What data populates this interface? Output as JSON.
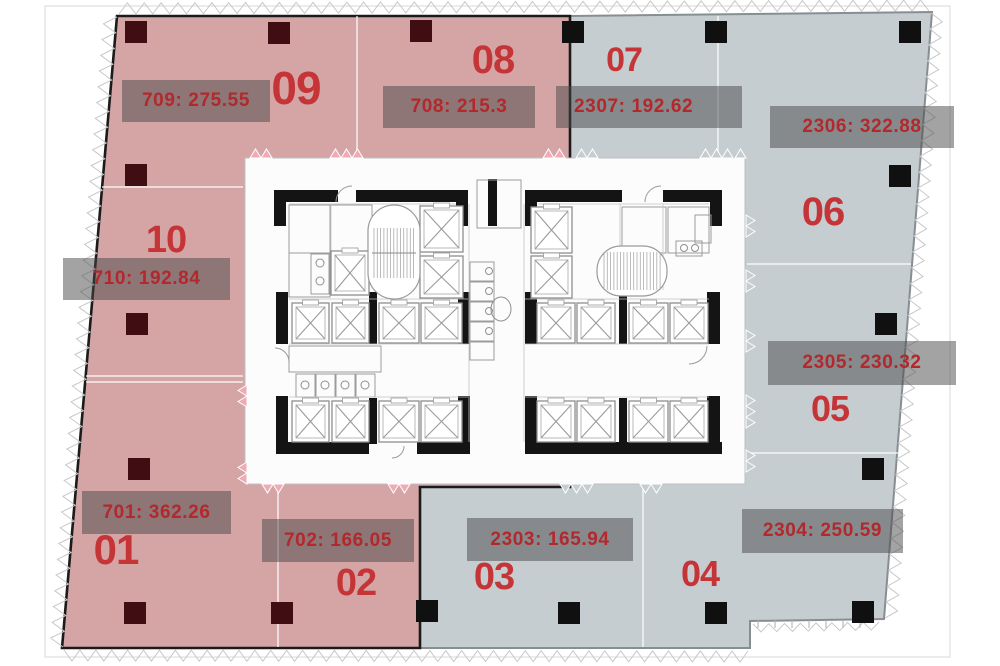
{
  "diagram_title": "Building floor plate with unit areas",
  "colors": {
    "pink": "#d5a5a5",
    "blue": "#c5cdd0",
    "pink_edge": "#1b1b1b",
    "blue_edge": "#878e92",
    "label_bg": "rgba(72,72,72,0.5)",
    "label_text": "#b2282c",
    "number_text": "#c53538",
    "column_dark": "#400d12",
    "column_black": "#101010",
    "plan_bg": "#fcfcfd",
    "hatch": "#c8c8c8",
    "door_tooth_pink": "#efaab5"
  },
  "units": [
    {
      "number": "09",
      "label": "709: 275.55",
      "zone": "pink"
    },
    {
      "number": "08",
      "label": "708: 215.3",
      "zone": "pink"
    },
    {
      "number": "07",
      "label": "2307: 192.62",
      "zone": "blue"
    },
    {
      "number": "06",
      "label": "2306: 322.88",
      "zone": "blue"
    },
    {
      "number": "10",
      "label": "710: 192.84",
      "zone": "pink"
    },
    {
      "number": "05",
      "label": "2305: 230.32",
      "zone": "blue"
    },
    {
      "number": "01",
      "label": "701: 362.26",
      "zone": "pink"
    },
    {
      "number": "02",
      "label": "702: 166.05",
      "zone": "pink"
    },
    {
      "number": "03",
      "label": "2303: 165.94",
      "zone": "blue"
    },
    {
      "number": "04",
      "label": "2304: 250.59",
      "zone": "blue"
    }
  ]
}
